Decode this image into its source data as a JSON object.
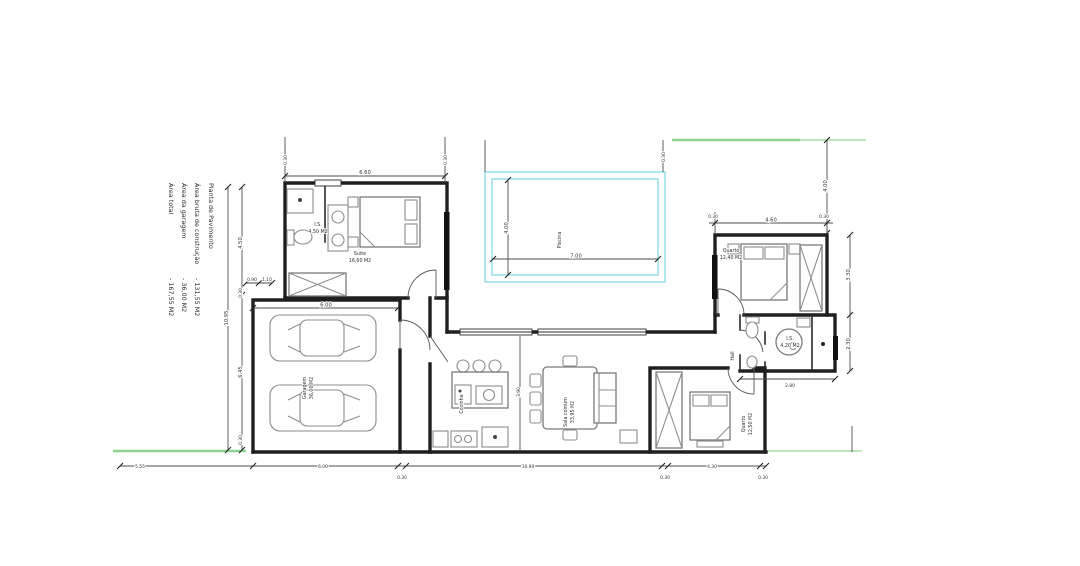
{
  "legend": {
    "title": "Planta de Pavimento",
    "items": [
      {
        "label": "Área bruta de construção",
        "value": "- 131,55 M2"
      },
      {
        "label": "Área da garagem",
        "value": "- 36,00 M2"
      },
      {
        "label": "Área total",
        "value": "- 167,55 M2"
      }
    ]
  },
  "rooms": {
    "suite": {
      "name": "Suite",
      "area": "16,60 M2"
    },
    "suite_bath": {
      "name": "I.S.",
      "area": "4,50 M2"
    },
    "garage": {
      "name": "Garagem",
      "area": "36,00 M2"
    },
    "pool": {
      "name": "Piscina"
    },
    "kitchen": {
      "name": "Cozinha"
    },
    "living": {
      "name": "Sala comum",
      "area": "33,95 M2"
    },
    "bedroom1": {
      "name": "Quarto",
      "area": "12,40 M2"
    },
    "bathroom": {
      "name": "I.S.",
      "area": "4,20 M2"
    },
    "hall": {
      "name": "Hall"
    },
    "bedroom2": {
      "name": "Quarto",
      "area": "12,50 M2"
    }
  },
  "dims": {
    "wall": "0.30",
    "top_left_width": "6.60",
    "left_total": "10.95",
    "left_upper": "4.50",
    "left_lower": "6.45",
    "small_a": "0.90",
    "small_b": "1.10",
    "garage_width": "6.00",
    "pool_width": "7.00",
    "pool_height": "4.00",
    "bedroom1_width": "4.60",
    "right_top": "4.00",
    "right_upper": "3.30",
    "right_lower": "2.30",
    "bath_width": "2.80",
    "living_divider": "3.90",
    "bottom_seg1": "5.55",
    "bottom_seg2": "6.00",
    "bottom_seg3": "10.90",
    "bottom_seg4": "4.30"
  }
}
